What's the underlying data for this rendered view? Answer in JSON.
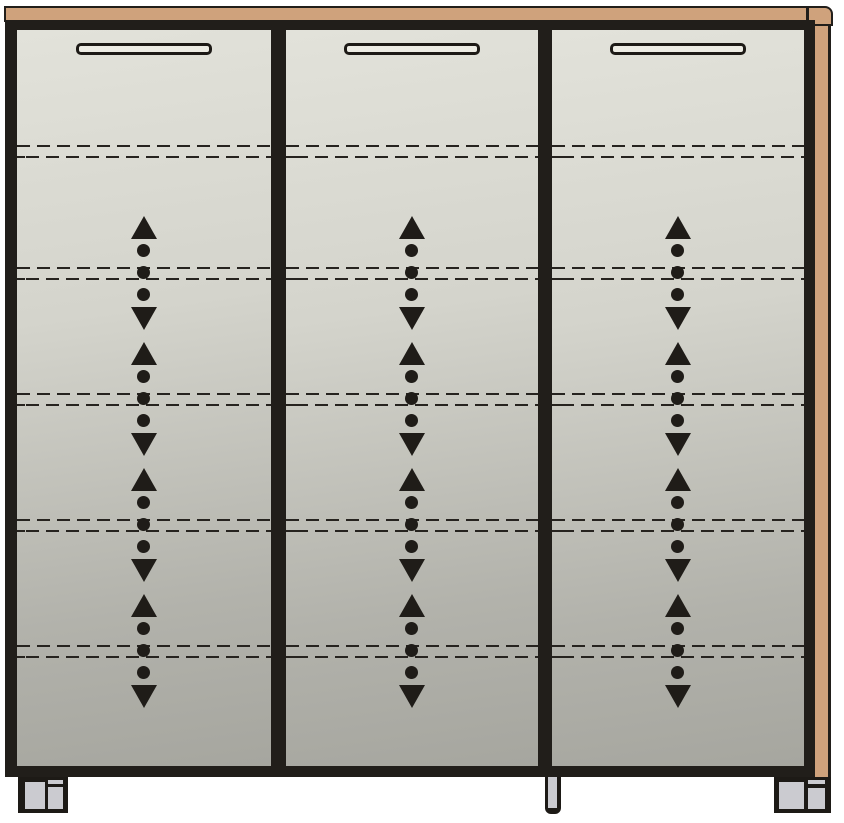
{
  "diagram": {
    "canvas": {
      "width": 844,
      "height": 823,
      "background": "#ffffff"
    },
    "colors": {
      "outline": "#211e1a",
      "wood": "#cfa27c",
      "door_gradient_top": "#e2e2da",
      "door_gradient_bottom": "#a6a69f",
      "handle_fill": "#edece4",
      "leg_fill": "#cbcbd0",
      "symbol": "#1f1c18"
    },
    "top_panel": {
      "x": 4,
      "y": 6,
      "w": 804,
      "h": 16
    },
    "end_cap": {
      "x": 807,
      "y": 6,
      "w": 26,
      "h": 20
    },
    "top_rail": {
      "x": 5,
      "y": 20,
      "w": 810,
      "h": 10
    },
    "left_stile": {
      "x": 5,
      "y": 20,
      "w": 12,
      "h": 757
    },
    "right_stile": {
      "x": 804,
      "y": 30,
      "w": 11,
      "h": 747
    },
    "bottom_rail": {
      "x": 5,
      "y": 766,
      "w": 810,
      "h": 11
    },
    "side_panel": {
      "x": 815,
      "y": 26,
      "w": 16,
      "h": 751
    },
    "dividers": [
      {
        "x": 271,
        "y": 30,
        "w": 15,
        "h": 747
      },
      {
        "x": 538,
        "y": 30,
        "w": 14,
        "h": 747
      }
    ],
    "door_y": 30,
    "door_h": 736,
    "doors": [
      {
        "id": "left",
        "x": 17,
        "w": 254
      },
      {
        "id": "middle",
        "x": 286,
        "w": 252
      },
      {
        "id": "right",
        "x": 552,
        "w": 252
      }
    ],
    "handle": {
      "w": 136,
      "h": 12,
      "top": 13,
      "border": 3
    },
    "shelf_lines_y": [
      151,
      273,
      399,
      525,
      651
    ],
    "shelf_line_offsets": [
      -6,
      5
    ],
    "arrow_rows_y": [
      273,
      399,
      525,
      651
    ],
    "arrow": {
      "cluster_w": 26,
      "cluster_h": 114,
      "dot_tops": [
        28,
        50,
        72
      ]
    },
    "legs": [
      {
        "id": "left",
        "style": "double",
        "x": 18,
        "y": 777,
        "w": 50,
        "h": 36,
        "front": {
          "x": 7,
          "y": 5,
          "w": 20,
          "h": 27
        },
        "sliver": {
          "x": 30,
          "y": 3,
          "w": 15,
          "h": 4
        },
        "side": {
          "x": 30,
          "y": 10,
          "w": 15,
          "h": 22
        }
      },
      {
        "id": "center",
        "style": "single",
        "x": 545,
        "y": 777,
        "w": 16,
        "h": 37
      },
      {
        "id": "right",
        "style": "double",
        "x": 774,
        "y": 777,
        "w": 57,
        "h": 36,
        "front": {
          "x": 5,
          "y": 5,
          "w": 25,
          "h": 27
        },
        "sliver": {
          "x": 34,
          "y": 3,
          "w": 17,
          "h": 4
        },
        "side": {
          "x": 34,
          "y": 11,
          "w": 17,
          "h": 21
        }
      }
    ]
  }
}
